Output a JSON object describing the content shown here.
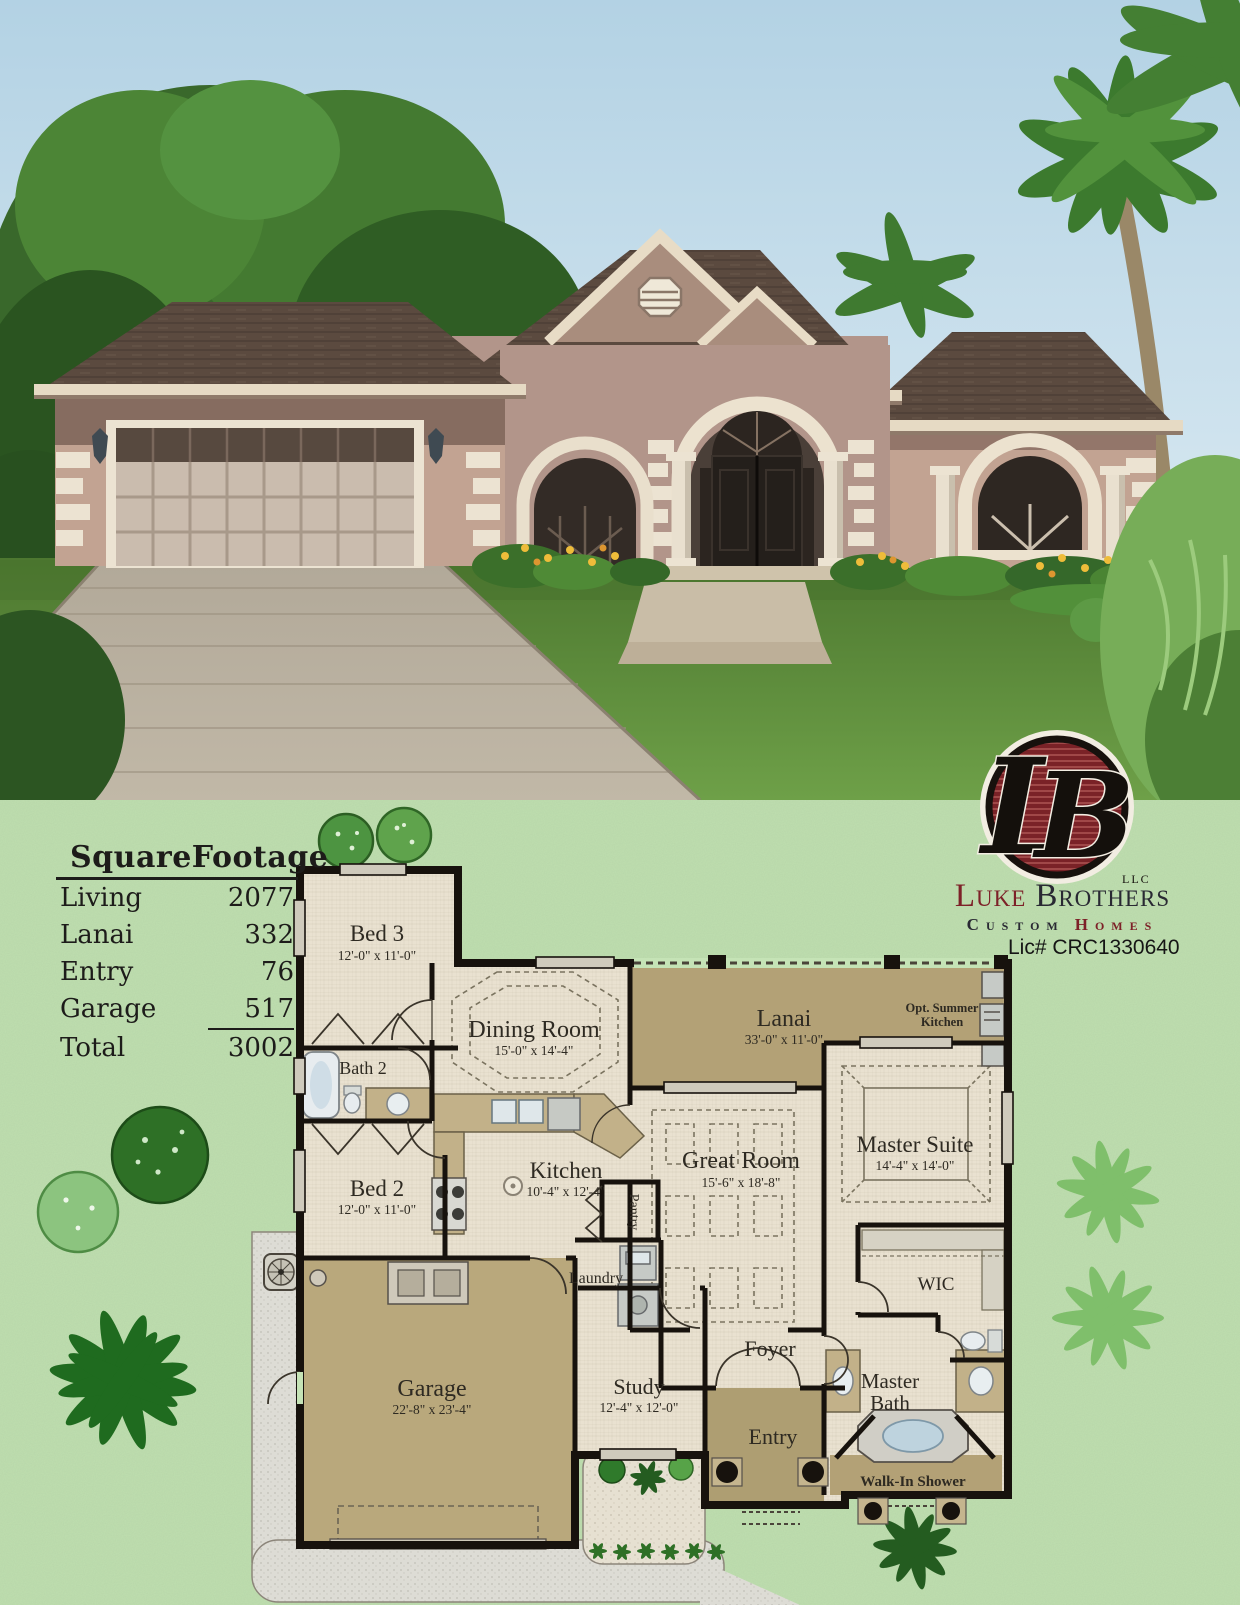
{
  "brand": {
    "monogram_l": "L",
    "monogram_b": "B",
    "monogram_suffix": "LLC",
    "name_word1": "Luke",
    "name_word2": "Brothers",
    "tagline_word1": "Custom",
    "tagline_word2": "Homes",
    "license": "Lic# CRC1330640"
  },
  "square_footage": {
    "title": "SquareFootage",
    "rows": [
      {
        "label": "Living",
        "value": "2077"
      },
      {
        "label": "Lanai",
        "value": "332"
      },
      {
        "label": "Entry",
        "value": "76"
      },
      {
        "label": "Garage",
        "value": "517"
      },
      {
        "label": "Total",
        "value": "3002"
      }
    ]
  },
  "floor_plan": {
    "bed3": {
      "name": "Bed 3",
      "dims": "12'-0\" x 11'-0\""
    },
    "bath2": {
      "name": "Bath 2"
    },
    "bed2": {
      "name": "Bed 2",
      "dims": "12'-0\" x 11'-0\""
    },
    "dining": {
      "name": "Dining Room",
      "dims": "15'-0\" x 14'-4\""
    },
    "kitchen": {
      "name": "Kitchen",
      "dims": "10'-4\" x 12'-4\""
    },
    "pantry": {
      "name": "Pantry"
    },
    "laundry": {
      "name": "Laundry"
    },
    "lanai": {
      "name": "Lanai",
      "dims": "33'-0\" x 11'-0\""
    },
    "summer_kitchen": {
      "line1": "Opt. Summer",
      "line2": "Kitchen"
    },
    "great_room": {
      "name": "Great Room",
      "dims": "15'-6\" x 18'-8\""
    },
    "master_suite": {
      "name": "Master Suite",
      "dims": "14'-4\" x 14'-0\""
    },
    "wic": {
      "name": "WIC"
    },
    "master_bath": {
      "line1": "Master",
      "line2": "Bath"
    },
    "walk_in_shower": {
      "name": "Walk-In Shower"
    },
    "foyer": {
      "name": "Foyer"
    },
    "study": {
      "name": "Study",
      "dims": "12'-4\" x 12'-0\""
    },
    "entry": {
      "name": "Entry"
    },
    "garage": {
      "name": "Garage",
      "dims": "22'-8\" x 23'-4\""
    }
  },
  "colors": {
    "flyer_background": "#c5e3b6",
    "plan_floor": "#e9e1d0",
    "plan_tan": "#b3a176",
    "wall_ink": "#17120d",
    "brand_red": "#7d2128",
    "brand_ink": "#292933",
    "sky": "#b3d2e4",
    "roof_brown": "#5b4a3f",
    "lawn_green": "#5d8f3c"
  }
}
